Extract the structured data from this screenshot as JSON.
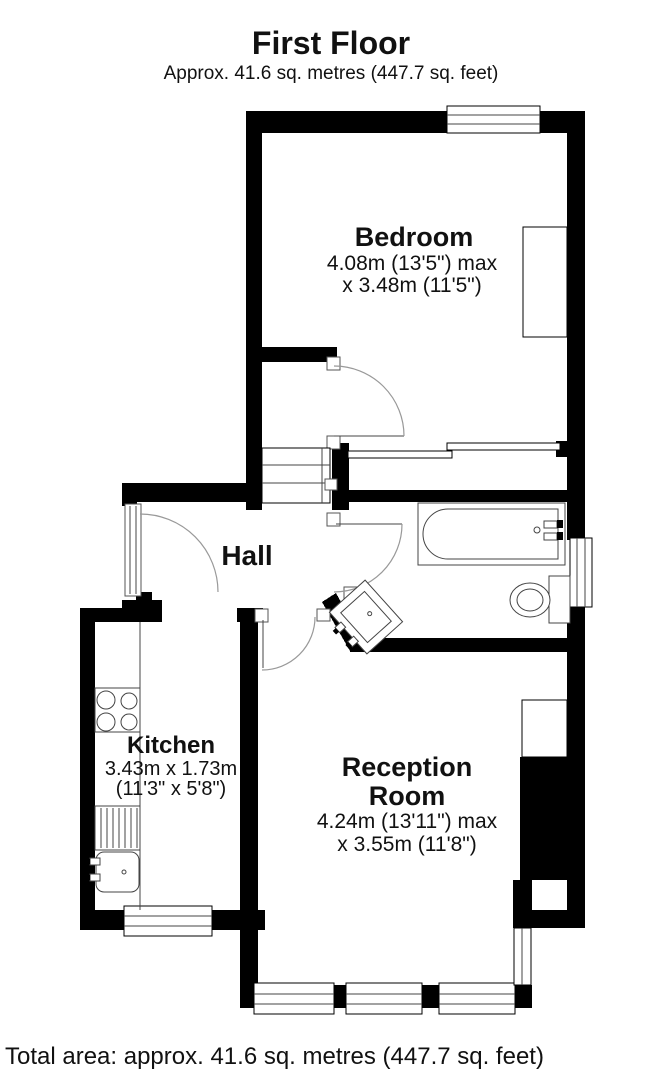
{
  "header": {
    "title": "First Floor",
    "subtitle": "Approx. 41.6 sq. metres (447.7 sq. feet)"
  },
  "rooms": {
    "bedroom": {
      "name": "Bedroom",
      "dim_line1": "4.08m (13'5\") max",
      "dim_line2": "x 3.48m (11'5\")"
    },
    "hall": {
      "name": "Hall"
    },
    "kitchen": {
      "name": "Kitchen",
      "dim_line1": "3.43m x 1.73m",
      "dim_line2": "(11'3\" x 5'8\")"
    },
    "reception": {
      "name_line1": "Reception",
      "name_line2": "Room",
      "dim_line1": "4.24m (13'11\") max",
      "dim_line2": "x 3.55m (11'8\")"
    }
  },
  "footer": {
    "total_area": "Total area: approx. 41.6 sq. metres (447.7 sq. feet)"
  },
  "fixtures": {
    "bathtub": "bathtub",
    "toilet": "toilet",
    "wash_basin": "wash-basin",
    "hob": "hob",
    "drainer": "draining-board",
    "kitchen_sink": "kitchen-sink",
    "stairs": "stairs",
    "wardrobe": "wardrobe",
    "cupboard": "cupboard"
  },
  "colors": {
    "wall": "#000000",
    "background": "#ffffff",
    "fixture_line": "#444444",
    "door_arc": "#999999"
  }
}
